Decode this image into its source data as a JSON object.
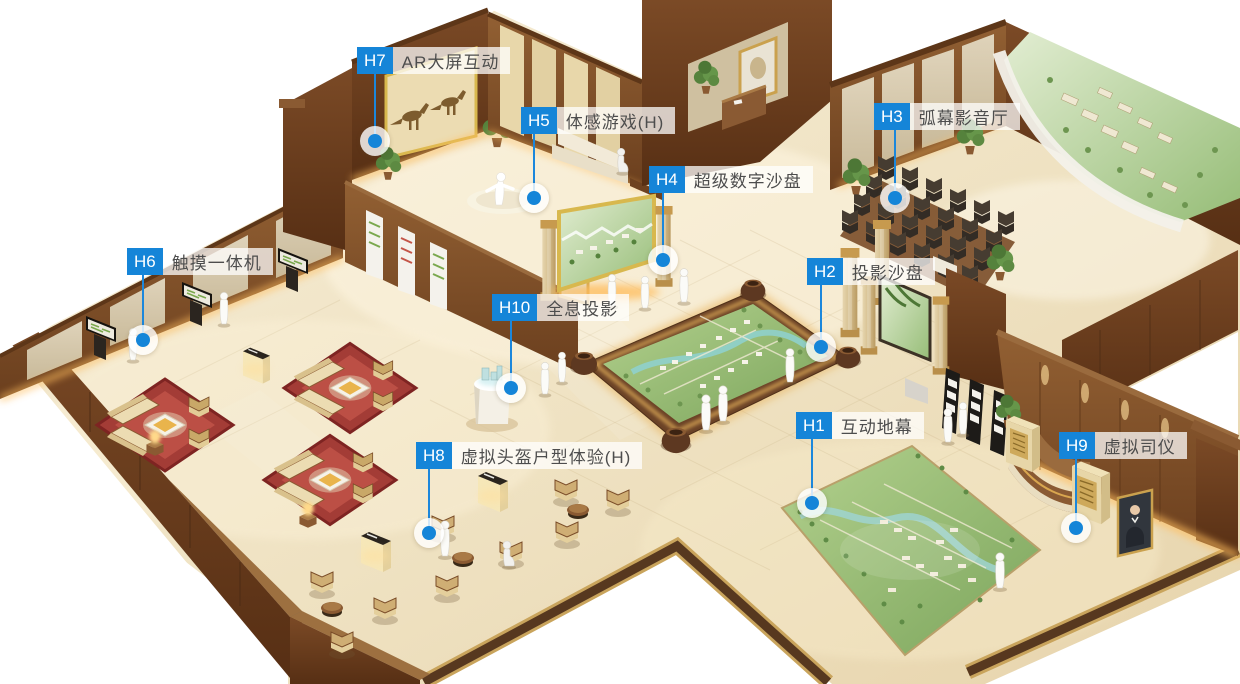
{
  "colors": {
    "accent_blue": "#1585d8",
    "leader_line": "#1b87dc",
    "label_text": "#4d4d4d",
    "label_bg": "rgba(255,255,255,0.74)"
  },
  "hotspots": [
    {
      "code": "H1",
      "label": "互动地幕"
    },
    {
      "code": "H2",
      "label": "投影沙盘"
    },
    {
      "code": "H3",
      "label": "弧幕影音厅"
    },
    {
      "code": "H4",
      "label": "超级数字沙盘"
    },
    {
      "code": "H5",
      "label": "体感游戏(H)"
    },
    {
      "code": "H6",
      "label": "触摸一体机"
    },
    {
      "code": "H7",
      "label": "AR大屏互动"
    },
    {
      "code": "H8",
      "label": "虚拟头盔户型体验(H)"
    },
    {
      "code": "H9",
      "label": "虚拟司仪"
    },
    {
      "code": "H10",
      "label": "全息投影"
    }
  ]
}
